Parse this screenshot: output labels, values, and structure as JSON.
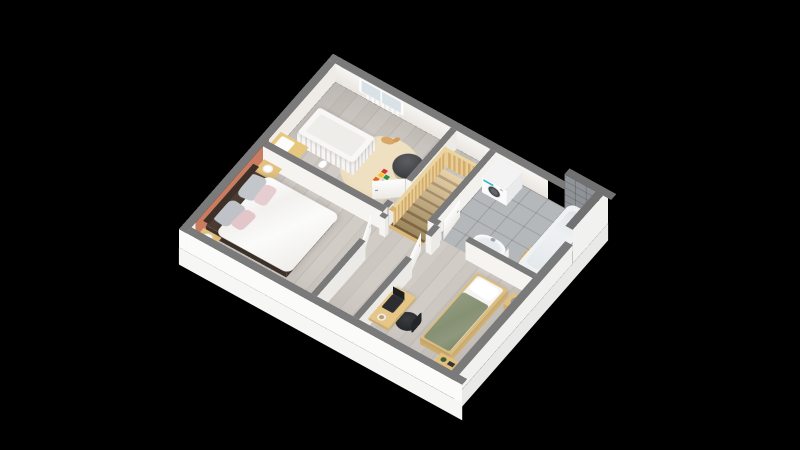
{
  "scene": {
    "type": "3d-floor-plan-render",
    "view": "axonometric cutaway of an upper storey, floating on black background",
    "background_color": "#000000",
    "palette": {
      "wall_cut_top": "#7a7a7a",
      "wall_face_white": "#f4f2ef",
      "accent_wall_salmon": "#c97c60",
      "wood_floor": "#cdc6c0",
      "bathroom_tile_floor": "#b5b8ba",
      "bathroom_tile_wall": "#8f9397",
      "stair_wood": "#dcbe85",
      "balustrade_wood": "#ecd49e",
      "furniture_wood": "#e3c17c",
      "bed_frame_dark": "#4a3c33",
      "duvet_white": "#fbfafa",
      "blanket_olive": "#8b9478",
      "rug_beige": "#e9d8b6",
      "bean_bag_gray": "#3f4245",
      "washer_accent_teal": "#2fb7c6",
      "slab_white": "#f6f6f5"
    },
    "rooms": [
      {
        "name": "nursery",
        "features": [
          "window-with-radiator"
        ],
        "furniture": [
          "white-crib",
          "changing-dresser",
          "round-rug",
          "toy-blocks",
          "rocking-horse",
          "bean-bag",
          "plush-bunny"
        ]
      },
      {
        "name": "master-bedroom",
        "features": [
          "salmon-accent-wall"
        ],
        "furniture": [
          "double-bed",
          "white-duvet",
          "gray-pillows",
          "pink-pillows",
          "nightstand-head-side",
          "nightstand-foot-side",
          "white-table-lamp-1",
          "white-table-lamp-2"
        ]
      },
      {
        "name": "hallway-landing",
        "features": [
          "staircase-down",
          "wooden-balustrade",
          "open-doors"
        ],
        "furniture": []
      },
      {
        "name": "bathroom",
        "features": [
          "tiled-floor",
          "tiled-accent-walls"
        ],
        "furniture": [
          "washing-machine",
          "washbasin",
          "bathtub",
          "wooden-bath-mat"
        ]
      },
      {
        "name": "bedroom",
        "features": [],
        "furniture": [
          "single-bed-olive-bedding",
          "nightstand",
          "gray-table-lamp",
          "desk",
          "laptop",
          "desk-lamp",
          "office-chair",
          "low-shelf-unit"
        ]
      }
    ],
    "doors_open_count": 4,
    "windows_count": 1
  }
}
